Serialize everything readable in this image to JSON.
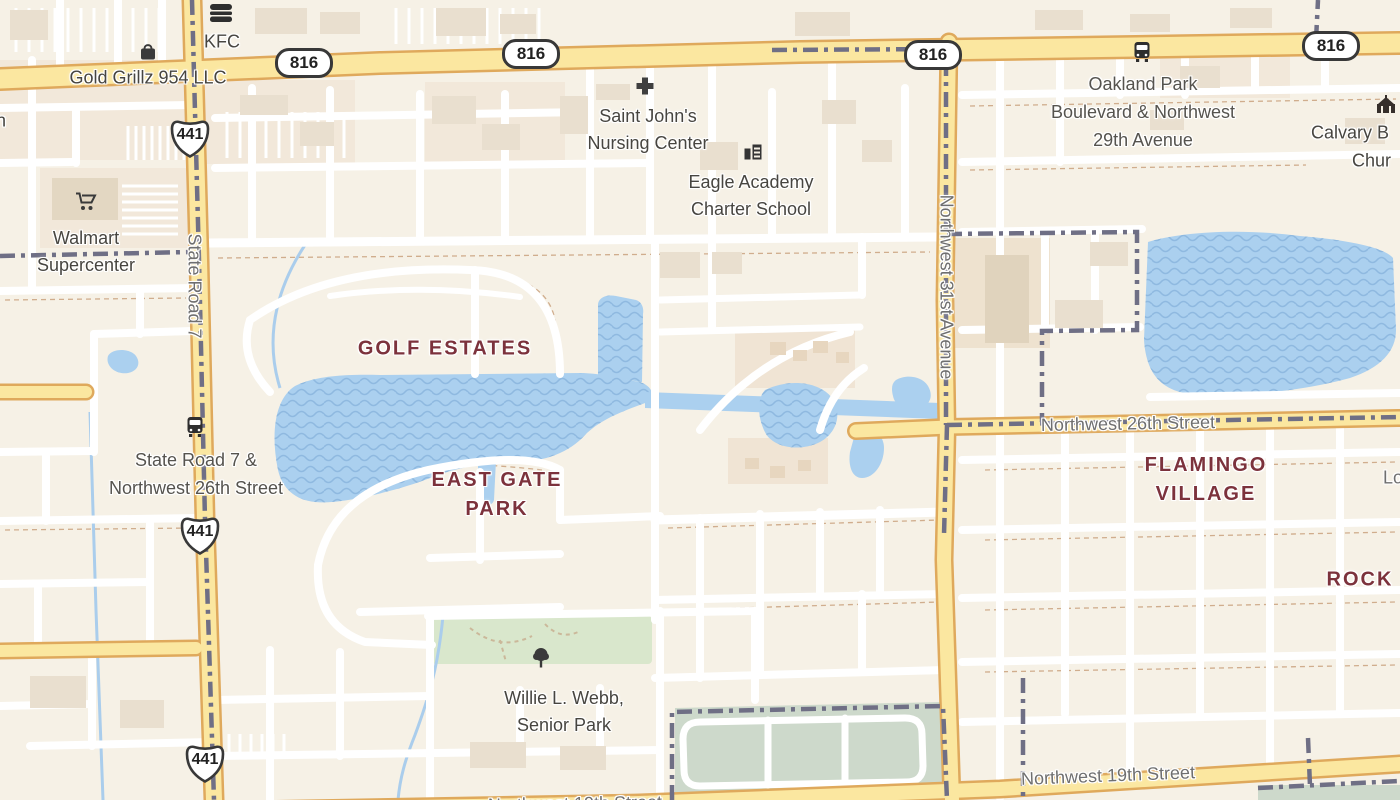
{
  "colors": {
    "land": "#f6f1e6",
    "water": "#abd0ef",
    "water_wave": "#8fb9e0",
    "road_major_fill": "#fbe7a0",
    "road_major_casing": "#dfa95c",
    "road_minor": "#ffffff",
    "park_green": "#d9e7cc",
    "campus_green": "#cdd9cb",
    "boundary_dash": "#6f6f85",
    "building": "#e9dfcf",
    "neighborhood_text": "#7c323c",
    "street_text": "#6f6f6f",
    "poi_text": "#474540"
  },
  "shields": {
    "route_816": "816",
    "route_441": "441"
  },
  "pois": {
    "gold_grillz": {
      "name": "Gold Grillz 954 LLC",
      "icon": "shopping-bag-icon"
    },
    "kfc": {
      "name": "KFC",
      "icon": "burger-icon"
    },
    "saint_johns": {
      "line1": "Saint John's",
      "line2": "Nursing Center",
      "icon": "medical-cross-icon"
    },
    "eagle_academy": {
      "line1": "Eagle Academy",
      "line2": "Charter School",
      "icon": "school-icon"
    },
    "walmart": {
      "line1": "Walmart",
      "line2": "Supercenter",
      "icon": "shopping-cart-icon"
    },
    "calvary_church": {
      "line1": "Calvary B",
      "line2": "Chur",
      "icon": "church-icon"
    },
    "willie_webb_park": {
      "line1": "Willie L. Webb,",
      "line2": "Senior Park",
      "icon": "tree-icon"
    }
  },
  "transit_stops": {
    "oakland_park": {
      "line1": "Oakland Park",
      "line2": "Boulevard & Northwest",
      "line3": "29th Avenue",
      "icon": "bus-icon"
    },
    "state_road_7": {
      "line1": "State Road 7 &",
      "line2": "Northwest 26th Street",
      "icon": "bus-icon"
    }
  },
  "streets": {
    "state_road_7": "State Road 7",
    "nw_31st_ave": "Northwest 31st Avenue",
    "nw_26th_st": "Northwest 26th Street",
    "nw_19th_st": "Northwest 19th Street"
  },
  "neighborhoods": {
    "golf_estates": "GOLF ESTATES",
    "east_gate_line1": "EAST GATE",
    "east_gate_line2": "PARK",
    "flamingo_line1": "FLAMINGO",
    "flamingo_line2": "VILLAGE",
    "rock": "ROCK"
  },
  "partial_labels": {
    "left_edge": "n",
    "right_edge": "Lo"
  }
}
